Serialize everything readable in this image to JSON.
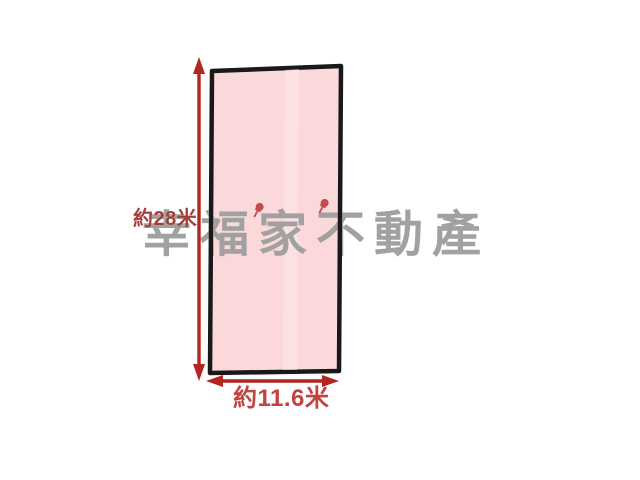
{
  "diagram": {
    "kind": "land-plot-sketch",
    "background_color": "#ffffff",
    "plot": {
      "fill_color": "#fbd9da",
      "seam_color": "#fee7e7",
      "border_color": "#191919"
    },
    "dimensions": {
      "arrow_color": "#b3251f",
      "height": {
        "label": "約28米",
        "color": "#a63e3a"
      },
      "width": {
        "label": "約11.6米",
        "color": "#c14442"
      }
    },
    "watermark": {
      "text": "幸福家不動產",
      "color": "#a1a1a1",
      "pin_color": "#c8494f"
    }
  }
}
